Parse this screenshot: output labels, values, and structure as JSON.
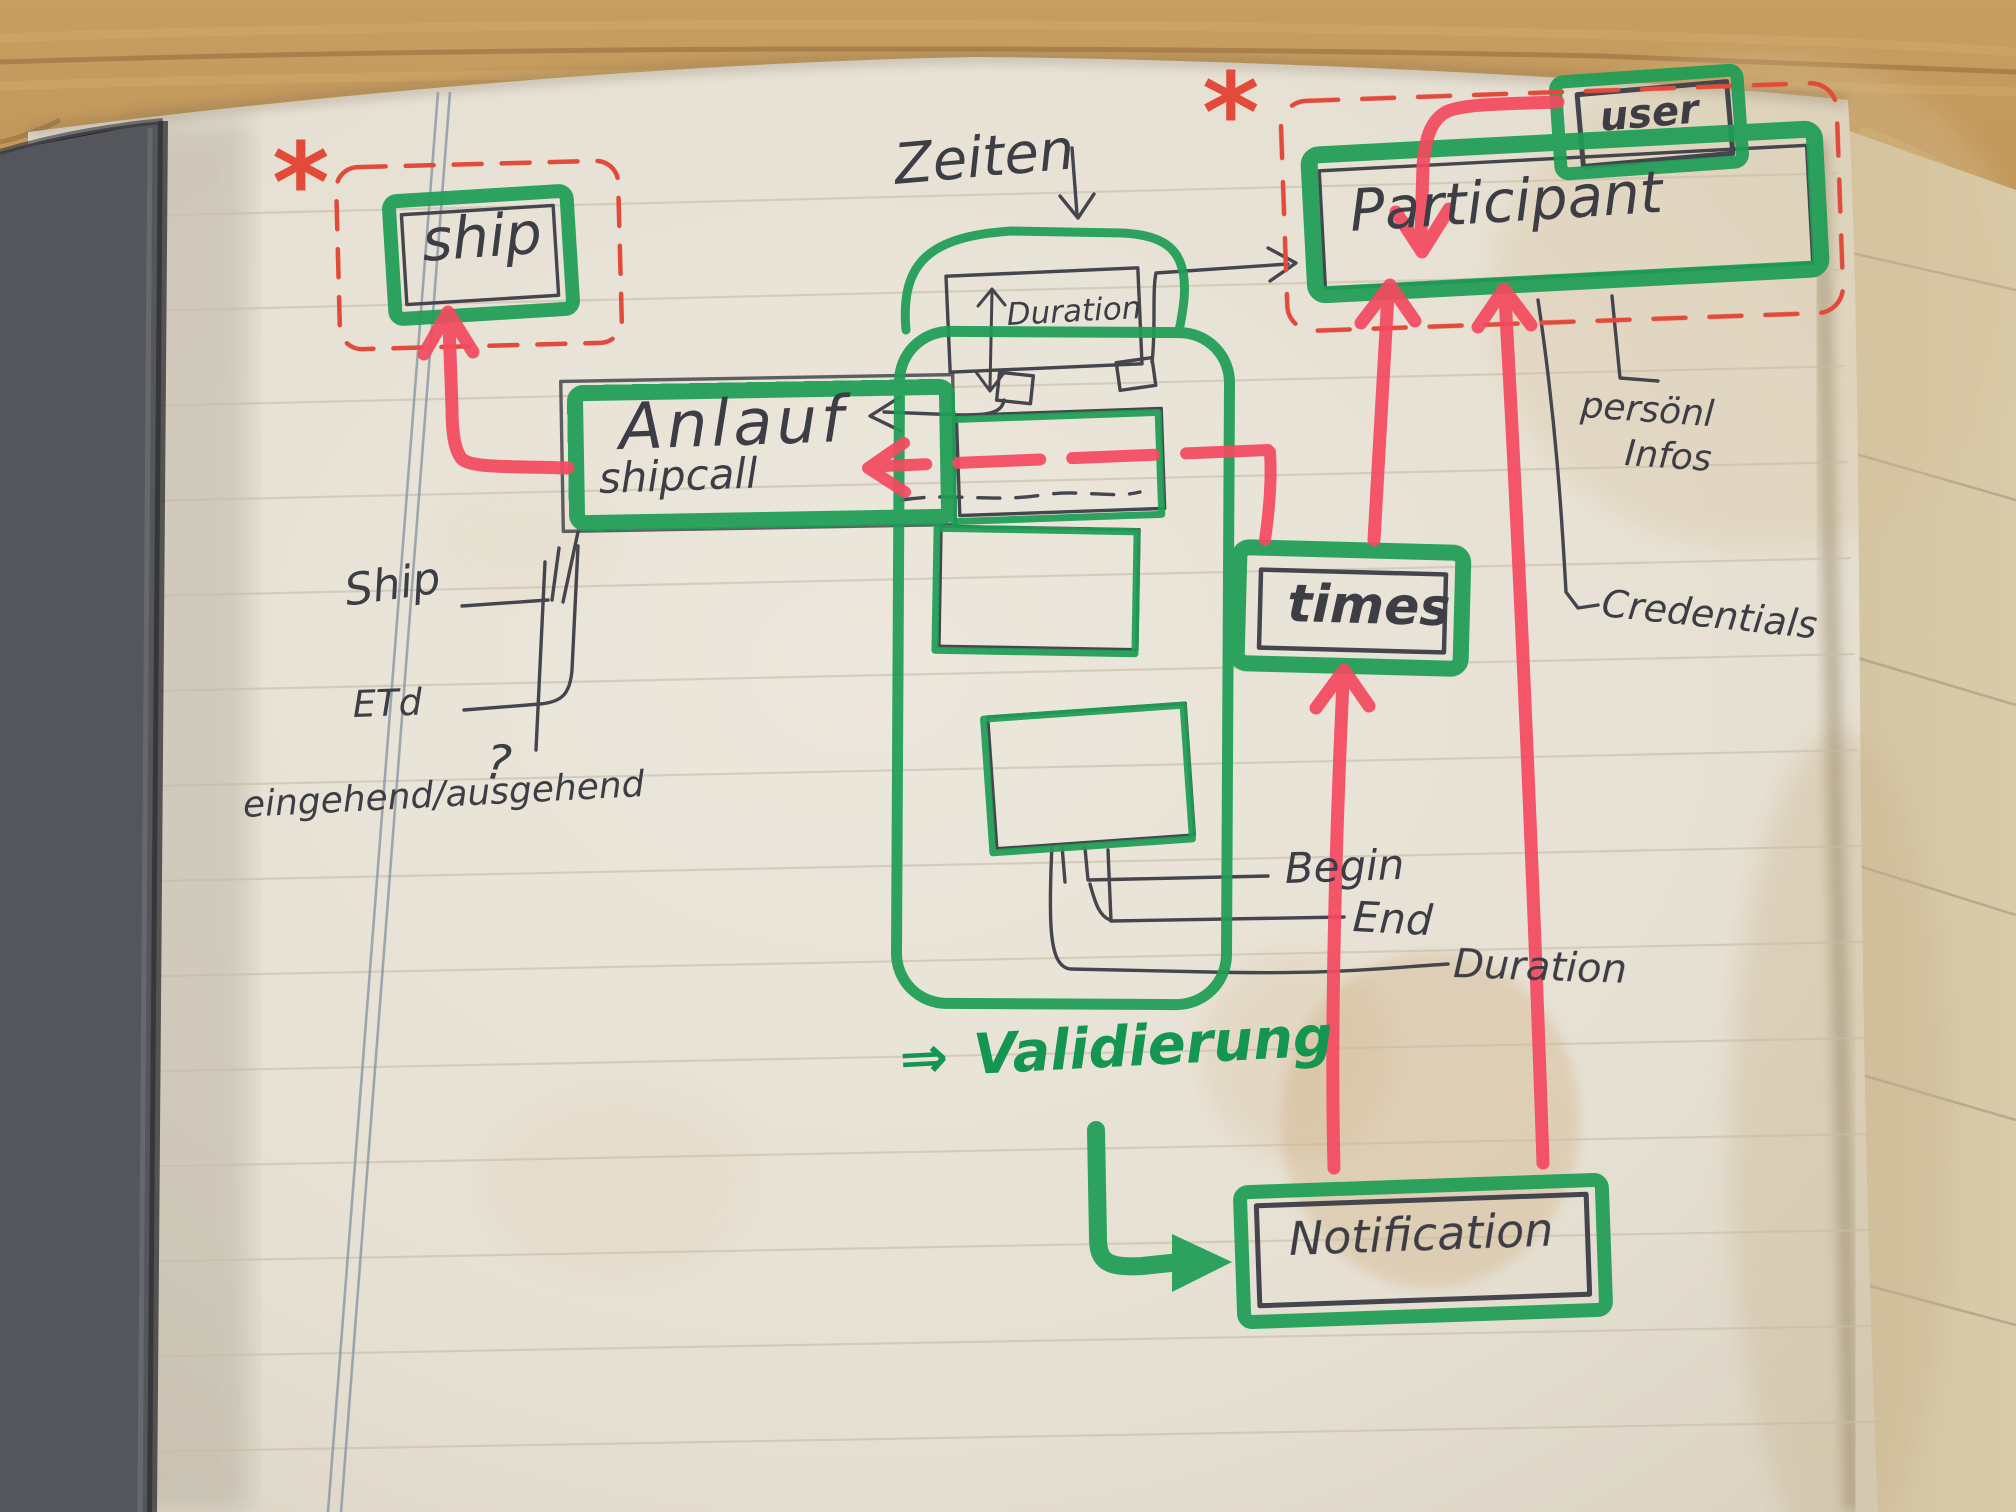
{
  "sketch": {
    "type": "hand-drawn entity diagram in a notebook",
    "entities": {
      "ship": "ship",
      "anlauf": "Anlauf",
      "shipcall": "shipcall",
      "participant": "Participant",
      "user": "user",
      "times": "times",
      "notification": "Notification",
      "duration_box": "Duration"
    },
    "annotations": {
      "zeiten": "Zeiten",
      "validierung_arrow": "⇒",
      "validierung": "Validierung",
      "ship_attr": "Ship",
      "etd": "ETd",
      "eingehend_ausgehend": "eingehend/ausgehend",
      "question_mark": "?",
      "begin": "Begin",
      "end": "End",
      "duration_attr": "Duration",
      "persoenl": "persönl",
      "infos": "Infos",
      "credentials": "Credentials",
      "asterisk_left": "*",
      "asterisk_right": "*"
    },
    "relations": [
      {
        "from": "Anlauf/shipcall",
        "to": "ship",
        "style": "red-marker-arrow"
      },
      {
        "from": "user",
        "to": "Participant",
        "style": "red-marker-arrow"
      },
      {
        "from": "times",
        "to": "Anlauf/shipcall",
        "style": "red-dashed-arrow"
      },
      {
        "from": "times",
        "to": "Participant",
        "style": "red-marker-arrow"
      },
      {
        "from": "Notification",
        "to": "times",
        "style": "red-marker-arrow"
      },
      {
        "from": "Notification",
        "to": "Participant",
        "style": "red-marker-arrow"
      },
      {
        "from": "Duration",
        "to": "Participant",
        "style": "pencil-arrow"
      },
      {
        "from": "Duration",
        "to": "Anlauf/shipcall",
        "style": "pencil-arrow"
      },
      {
        "from": "Validierung",
        "to": "Notification",
        "style": "green-hook-arrow"
      }
    ],
    "attribute_links": {
      "anlauf": [
        "Ship",
        "ETd",
        "eingehend/ausgehend ?"
      ],
      "times_inner_boxes": [
        "Begin",
        "End",
        "Duration"
      ],
      "participant": [
        "persönl Infos",
        "Credentials"
      ]
    },
    "colors": {
      "marker_green": "#1f9e55",
      "marker_red": "#f4495f",
      "pen_red": "#e24a3a",
      "pencil": "#45454e",
      "paper": "#e9e3d7",
      "wood": "#b6894e",
      "cover": "#53555b"
    }
  }
}
